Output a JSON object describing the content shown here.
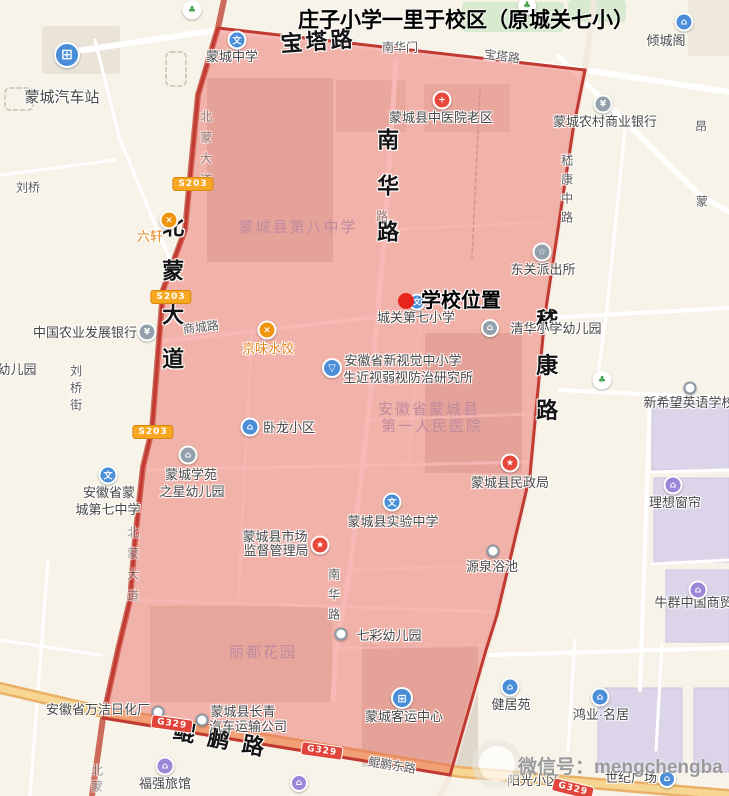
{
  "title": "庄子小学一里于校区（原城关七小）",
  "watermark": "微信号：mengchengba",
  "district": {
    "name": "校区范围",
    "fill_color": "#e85a50",
    "border_color": "#c03a32"
  },
  "map": {
    "marker": {
      "label": "学校位置",
      "dot_x": 406,
      "dot_y": 301,
      "label_x": 461,
      "label_y": 301
    },
    "icon_glyphs": {
      "school": "文",
      "hospital": "+",
      "bank": "¥",
      "police": "☆",
      "restaurant": "×",
      "flask": "▽",
      "kindergarten": "⌂",
      "residence": "⌂",
      "bus": "⊞",
      "park": "♣",
      "gov": "★",
      "shopping": "⌂",
      "hotel": "⌂",
      "pagoda": "⌂",
      "ring": ""
    },
    "labels": [
      {
        "t": "宝塔路",
        "x": 318,
        "y": 42,
        "c": "big",
        "r": -4,
        "ls": 3,
        "n": "road-label-baota-road"
      },
      {
        "t": "南华路",
        "x": 386,
        "y": 197,
        "c": "big v",
        "ls": 24,
        "n": "road-label-nanhua-road"
      },
      {
        "t": "北蒙大道",
        "x": 171,
        "y": 303,
        "c": "big v",
        "ls": 22,
        "n": "road-label-beimeng-avenue"
      },
      {
        "t": "嵇康路",
        "x": 545,
        "y": 376,
        "c": "big v",
        "ls": 23,
        "n": "road-label-jikang-road"
      },
      {
        "t": "鲲鹏路",
        "x": 225,
        "y": 741,
        "c": "big",
        "r": 11,
        "ls": 13,
        "n": "road-label-kunpeng-road"
      },
      {
        "t": "嵇康中路",
        "x": 566,
        "y": 192,
        "c": "sm v",
        "ls": 7,
        "n": "road-label-jikang-middle-road"
      },
      {
        "t": "北蒙大道",
        "x": 205,
        "y": 152,
        "c": "sm v dim",
        "ls": 9,
        "n": "road-label-beimeng-avenue-small"
      },
      {
        "t": "北蒙大道",
        "x": 132,
        "y": 568,
        "c": "sm v dim",
        "ls": 9,
        "n": "road-label-beimeng-avenue-small"
      },
      {
        "t": "北蒙",
        "x": 96,
        "y": 780,
        "c": "sm v dim",
        "ls": 4,
        "n": "road-label-beimeng-partial"
      },
      {
        "t": "南华路",
        "x": 333,
        "y": 598,
        "c": "sm v",
        "ls": 8,
        "n": "road-label-nanhua-road-small"
      },
      {
        "t": "路",
        "x": 382,
        "y": 217,
        "c": "sm dim",
        "n": "road-label-fragment"
      },
      {
        "t": "南华门",
        "x": 400,
        "y": 48,
        "c": "sm",
        "n": "poi-label-nanhuamen"
      },
      {
        "t": "宝塔路",
        "x": 502,
        "y": 57,
        "c": "sm",
        "r": 7,
        "n": "road-label-baota-road-small"
      },
      {
        "t": "商城路",
        "x": 201,
        "y": 328,
        "c": "sm",
        "r": -7,
        "n": "road-label-shangcheng-road"
      },
      {
        "t": "鲲鹏东路",
        "x": 392,
        "y": 766,
        "c": "sm",
        "r": 9,
        "n": "road-label-kunpeng-east-road"
      },
      {
        "t": "刘桥街",
        "x": 75,
        "y": 390,
        "c": "sm v",
        "ls": 5,
        "n": "road-label-liuqiao-street"
      },
      {
        "t": "刘桥",
        "x": 28,
        "y": 188,
        "c": "sm",
        "n": "poi-label-liuqiao"
      },
      {
        "t": "昂",
        "x": 701,
        "y": 127,
        "c": "sm",
        "n": "poi-label-partial"
      },
      {
        "t": "蒙",
        "x": 702,
        "y": 202,
        "c": "sm",
        "n": "poi-label-partial"
      },
      {
        "t": "蒙城汽车站",
        "x": 62,
        "y": 98,
        "c": "poi lg",
        "n": "poi-label-bus-station"
      },
      {
        "t": "蒙城中学",
        "x": 232,
        "y": 57,
        "c": "poi",
        "n": "poi-label-mengcheng-middle-school"
      },
      {
        "t": "倾城阁",
        "x": 666,
        "y": 41,
        "c": "poi",
        "n": "poi-label-qingchengge"
      },
      {
        "t": "蒙城县中医院老区",
        "x": 441,
        "y": 118,
        "c": "poi",
        "n": "poi-label-tcm-hospital"
      },
      {
        "t": "蒙城农村商业银行",
        "x": 605,
        "y": 122,
        "c": "poi",
        "n": "poi-label-rural-bank"
      },
      {
        "t": "东关派出所",
        "x": 543,
        "y": 270,
        "c": "poi",
        "n": "poi-label-police-station"
      },
      {
        "t": "城关第七小学",
        "x": 416,
        "y": 318,
        "c": "poi",
        "n": "poi-label-chengguan-no7-primary"
      },
      {
        "t": "清华小学幼儿园",
        "x": 556,
        "y": 329,
        "c": "poi",
        "n": "poi-label-qinghua-kindergarten"
      },
      {
        "t": "安徽省新视觉中小学",
        "x": 403,
        "y": 361,
        "c": "poi",
        "n": "poi-label-vision-institute-line1"
      },
      {
        "t": "生近视弱视防治研究所",
        "x": 408,
        "y": 378,
        "c": "poi",
        "n": "poi-label-vision-institute-line2"
      },
      {
        "t": "京味水饺",
        "x": 268,
        "y": 349,
        "c": "poi orange",
        "n": "poi-label-jingwei-dumplings"
      },
      {
        "t": "六轩",
        "x": 150,
        "y": 237,
        "c": "poi orange",
        "n": "poi-label-liuxuan"
      },
      {
        "t": "中国农业发展银行",
        "x": 85,
        "y": 333,
        "c": "poi",
        "n": "poi-label-agri-development-bank"
      },
      {
        "t": "幼儿园",
        "x": 17,
        "y": 370,
        "c": "poi",
        "n": "poi-label-kindergarten-partial"
      },
      {
        "t": "卧龙小区",
        "x": 289,
        "y": 428,
        "c": "poi",
        "n": "poi-label-wolong-community"
      },
      {
        "t": "安徽省蒙城县",
        "x": 429,
        "y": 410,
        "c": "aoi",
        "n": "aoi-label-first-peoples-hospital-line1"
      },
      {
        "t": "第一人民医院",
        "x": 432,
        "y": 427,
        "c": "aoi",
        "n": "aoi-label-first-peoples-hospital-line2"
      },
      {
        "t": "蒙城县第八中学",
        "x": 298,
        "y": 228,
        "c": "aoi",
        "n": "aoi-label-no8-middle-school"
      },
      {
        "t": "蒙城学苑",
        "x": 191,
        "y": 475,
        "c": "poi",
        "n": "poi-label-xueyuan-kindergarten-line1"
      },
      {
        "t": "之星幼儿园",
        "x": 192,
        "y": 492,
        "c": "poi",
        "n": "poi-label-xueyuan-kindergarten-line2"
      },
      {
        "t": "安徽省蒙",
        "x": 109,
        "y": 493,
        "c": "poi",
        "n": "poi-label-no7-middle-school-line1"
      },
      {
        "t": "城第七中学",
        "x": 108,
        "y": 510,
        "c": "poi",
        "n": "poi-label-no7-middle-school-line2"
      },
      {
        "t": "蒙城县市场",
        "x": 275,
        "y": 537,
        "c": "poi",
        "n": "poi-label-market-bureau-line1"
      },
      {
        "t": "监督管理局",
        "x": 276,
        "y": 551,
        "c": "poi",
        "n": "poi-label-market-bureau-line2"
      },
      {
        "t": "蒙城县实验中学",
        "x": 393,
        "y": 522,
        "c": "poi",
        "n": "poi-label-experimental-middle-school"
      },
      {
        "t": "蒙城县民政局",
        "x": 510,
        "y": 483,
        "c": "poi",
        "n": "poi-label-civil-affairs-bureau"
      },
      {
        "t": "源泉浴池",
        "x": 492,
        "y": 567,
        "c": "poi",
        "n": "poi-label-yuanquan-bathhouse"
      },
      {
        "t": "理想窗帘",
        "x": 675,
        "y": 503,
        "c": "poi",
        "n": "poi-label-lixiang-curtains"
      },
      {
        "t": "新希望英语学校",
        "x": 689,
        "y": 403,
        "c": "poi",
        "n": "poi-label-new-hope-english-school"
      },
      {
        "t": "牛群中国商贸城",
        "x": 700,
        "y": 603,
        "c": "poi",
        "n": "poi-label-niuqun-trade-city"
      },
      {
        "t": "七彩幼儿园",
        "x": 389,
        "y": 636,
        "c": "poi",
        "n": "poi-label-qicai-kindergarten"
      },
      {
        "t": "丽都花园",
        "x": 263,
        "y": 653,
        "c": "aoi",
        "n": "aoi-label-lidu-garden"
      },
      {
        "t": "安徽省万洁日化厂",
        "x": 98,
        "y": 710,
        "c": "poi",
        "n": "poi-label-wanjie-daily-chemical"
      },
      {
        "t": "蒙城县长青",
        "x": 243,
        "y": 712,
        "c": "poi",
        "n": "poi-label-changqing-transport-line1"
      },
      {
        "t": "汽车运输公司",
        "x": 248,
        "y": 727,
        "c": "poi",
        "n": "poi-label-changqing-transport-line2"
      },
      {
        "t": "蒙城客运中心",
        "x": 404,
        "y": 717,
        "c": "poi",
        "n": "poi-label-passenger-center"
      },
      {
        "t": "健居苑",
        "x": 511,
        "y": 705,
        "c": "poi",
        "n": "poi-label-jianjuyuan"
      },
      {
        "t": "鸿业·名居",
        "x": 601,
        "y": 715,
        "c": "poi",
        "n": "poi-label-hongye-mingju"
      },
      {
        "t": "阳光小区",
        "x": 533,
        "y": 781,
        "c": "poi",
        "n": "poi-label-yangguang-community"
      },
      {
        "t": "世纪广场",
        "x": 631,
        "y": 778,
        "c": "poi",
        "n": "poi-label-century-plaza"
      },
      {
        "t": "福强旅馆",
        "x": 165,
        "y": 784,
        "c": "poi",
        "n": "poi-label-fuqiang-hotel"
      }
    ],
    "icons": [
      {
        "k": "bus",
        "x": 67,
        "y": 55,
        "s": 22,
        "n": "bus-station-icon"
      },
      {
        "k": "school",
        "x": 237,
        "y": 40,
        "s": 15,
        "n": "middle-school-icon"
      },
      {
        "k": "park",
        "x": 192,
        "y": 10,
        "s": 15,
        "n": "park-tree-icon"
      },
      {
        "k": "park",
        "x": 527,
        "y": 6,
        "s": 14,
        "n": "park-tree-icon"
      },
      {
        "k": "pagoda",
        "x": 684,
        "y": 22,
        "s": 15,
        "n": "pagoda-icon"
      },
      {
        "k": "hospital",
        "x": 442,
        "y": 100,
        "s": 15,
        "n": "hospital-cross-icon"
      },
      {
        "k": "bank",
        "x": 603,
        "y": 104,
        "s": 15,
        "n": "bank-icon"
      },
      {
        "k": "bank",
        "x": 147,
        "y": 332,
        "s": 15,
        "n": "bank-icon"
      },
      {
        "k": "police",
        "x": 542,
        "y": 252,
        "s": 15,
        "n": "police-badge-icon"
      },
      {
        "k": "restaurant",
        "x": 267,
        "y": 330,
        "s": 15,
        "n": "restaurant-icon"
      },
      {
        "k": "restaurant",
        "x": 169,
        "y": 220,
        "s": 15,
        "n": "restaurant-icon"
      },
      {
        "k": "school",
        "x": 417,
        "y": 302,
        "s": 13,
        "n": "primary-school-icon"
      },
      {
        "k": "flask",
        "x": 332,
        "y": 368,
        "s": 16,
        "n": "research-institute-icon"
      },
      {
        "k": "kindergarten",
        "x": 490,
        "y": 328,
        "s": 14,
        "n": "kindergarten-icon"
      },
      {
        "k": "kindergarten",
        "x": 188,
        "y": 455,
        "s": 15,
        "n": "kindergarten-icon"
      },
      {
        "k": "school",
        "x": 108,
        "y": 475,
        "s": 15,
        "n": "school-icon"
      },
      {
        "k": "school",
        "x": 392,
        "y": 502,
        "s": 15,
        "n": "school-icon"
      },
      {
        "k": "gov",
        "x": 510,
        "y": 463,
        "s": 15,
        "n": "government-star-icon"
      },
      {
        "k": "gov",
        "x": 320,
        "y": 545,
        "s": 15,
        "n": "government-star-icon"
      },
      {
        "k": "residence",
        "x": 250,
        "y": 427,
        "s": 15,
        "n": "residence-icon"
      },
      {
        "k": "residence",
        "x": 510,
        "y": 687,
        "s": 15,
        "n": "residence-icon"
      },
      {
        "k": "residence",
        "x": 600,
        "y": 697,
        "s": 15,
        "n": "residence-icon"
      },
      {
        "k": "residence",
        "x": 667,
        "y": 779,
        "s": 14,
        "n": "residence-icon"
      },
      {
        "k": "shopping",
        "x": 673,
        "y": 485,
        "s": 15,
        "n": "shopping-icon"
      },
      {
        "k": "shopping",
        "x": 698,
        "y": 590,
        "s": 15,
        "n": "shopping-icon"
      },
      {
        "k": "hotel",
        "x": 165,
        "y": 766,
        "s": 15,
        "n": "hotel-icon"
      },
      {
        "k": "hotel",
        "x": 299,
        "y": 783,
        "s": 14,
        "n": "hotel-icon"
      },
      {
        "k": "bus",
        "x": 402,
        "y": 698,
        "s": 18,
        "n": "bus-terminal-icon"
      },
      {
        "k": "park",
        "x": 602,
        "y": 380,
        "s": 15,
        "n": "scenic-leaf-icon"
      },
      {
        "k": "ring",
        "x": 690,
        "y": 388,
        "s": 9,
        "n": "poi-ring-icon"
      },
      {
        "k": "ring",
        "x": 493,
        "y": 551,
        "s": 9,
        "n": "poi-ring-icon"
      },
      {
        "k": "ring",
        "x": 341,
        "y": 634,
        "s": 9,
        "n": "poi-ring-icon"
      },
      {
        "k": "ring",
        "x": 158,
        "y": 712,
        "s": 9,
        "n": "poi-ring-icon"
      },
      {
        "k": "ring",
        "x": 202,
        "y": 720,
        "s": 9,
        "n": "poi-ring-icon"
      }
    ],
    "badges": [
      {
        "t": "S203",
        "k": "s",
        "x": 193,
        "y": 184,
        "n": "road-badge-s203"
      },
      {
        "t": "S203",
        "k": "s",
        "x": 171,
        "y": 297,
        "n": "road-badge-s203"
      },
      {
        "t": "S203",
        "k": "s",
        "x": 153,
        "y": 432,
        "n": "road-badge-s203"
      },
      {
        "t": "G329",
        "k": "g",
        "x": 172,
        "y": 724,
        "r": 8,
        "n": "road-badge-g329"
      },
      {
        "t": "G329",
        "k": "g",
        "x": 322,
        "y": 751,
        "r": 8,
        "n": "road-badge-g329"
      },
      {
        "t": "G329",
        "k": "g",
        "x": 573,
        "y": 789,
        "r": 14,
        "n": "road-badge-g329"
      }
    ]
  }
}
